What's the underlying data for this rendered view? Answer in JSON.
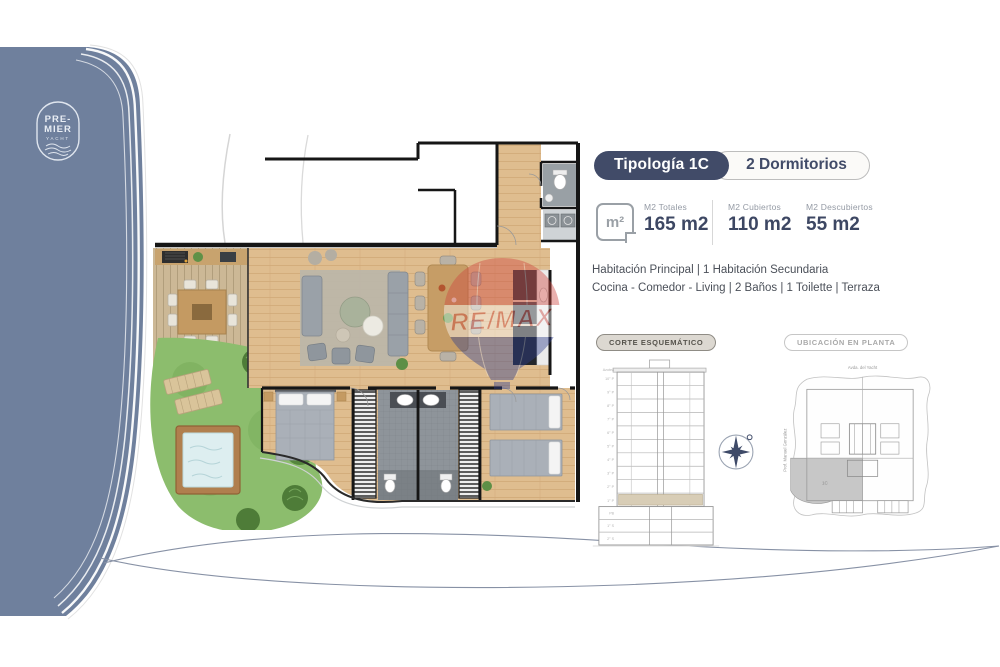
{
  "brand": {
    "name": "Premier Yacht",
    "line1": "PRE-",
    "line2": "MIER",
    "line3": "YACHT"
  },
  "header": {
    "typology": "Tipología 1C",
    "bedrooms": "2 Dormitorios"
  },
  "stats": {
    "icon_label": "m²",
    "items": [
      {
        "label": "M2 Totales",
        "value": "165 m2"
      },
      {
        "label": "M2 Cubiertos",
        "value": "110 m2"
      },
      {
        "label": "M2 Descubiertos",
        "value": "55 m2"
      }
    ]
  },
  "description": {
    "line1": "Habitación Principal | 1 Habitación Secundaria",
    "line2": "Cocina - Comedor - Living | 2 Baños | 1 Toilette | Terraza"
  },
  "sections": {
    "corte_label": "CORTE ESQUEMÁTICO",
    "ubicacion_label": "UBICACIÓN EN PLANTA"
  },
  "corte": {
    "floors": [
      "Azotea",
      "10° P",
      "9° P",
      "8° P",
      "7° P",
      "6° P",
      "5° P",
      "4° P",
      "3° P",
      "2° P",
      "1° P",
      "PB",
      "1° S",
      "2° S"
    ],
    "highlighted_floor": "1° P"
  },
  "ubicacion": {
    "street_top": "Avda. del Yacht",
    "street_left": "Prof. Manuel González",
    "unit_label": "1C"
  },
  "watermark": {
    "text": "RE/MAX"
  },
  "colors": {
    "brand_blue": "#6f809d",
    "navy": "#414b68",
    "accent_beige": "#d8cdb6",
    "remax_red": "#cf463f",
    "remax_blue": "#2f3f8e"
  }
}
